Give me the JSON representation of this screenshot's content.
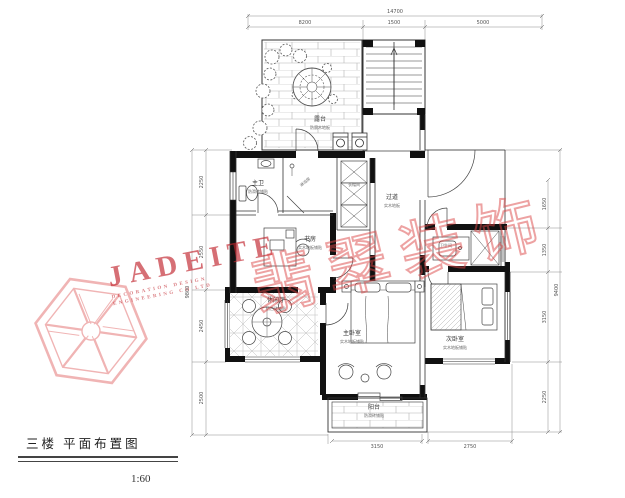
{
  "drawing": {
    "title": "三楼 平面布置图",
    "scale": "1:60"
  },
  "watermark": {
    "latin": "JADEITE",
    "sub1": "DECORATION DESIGN",
    "sub2": "ENGINEERING CO LTD",
    "cn": "翡翠装饰",
    "color": "#c1242d"
  },
  "rooms": {
    "terrace": {
      "name": "露台",
      "note": "防腐木地板"
    },
    "shower": {
      "name": "淋浴房",
      "note": ""
    },
    "master_bath": {
      "name": "主卫",
      "note": "防滑砖铺贴"
    },
    "cloakroom": {
      "name": "衣帽间",
      "note": ""
    },
    "corridor": {
      "name": "过道",
      "note": "实木地板"
    },
    "study": {
      "name": "书房",
      "note": "实木地板铺贴"
    },
    "leisure": {
      "name": "休闲厅",
      "note": "仿古砖铺贴"
    },
    "master_bedroom": {
      "name": "主卧室",
      "note": "实木地板铺贴"
    },
    "second_bedroom": {
      "name": "次卧室",
      "note": "实木地板铺贴"
    },
    "bathroom2": {
      "name": "卫生间",
      "note": ""
    },
    "balcony": {
      "name": "阳台",
      "note": "防滑砖铺贴"
    }
  },
  "dims": {
    "top_total": "14700",
    "top_a": "8200",
    "top_b": "1500",
    "top_c": "5000",
    "left_total": "9800",
    "left_a": "2250",
    "left_b": "2550",
    "left_c": "2450",
    "left_d": "2500",
    "right_total": "9400",
    "right_a": "1650",
    "right_b": "1350",
    "right_c": "3150",
    "right_d": "2250",
    "bottom_a": "3150",
    "bottom_b": "2750"
  }
}
